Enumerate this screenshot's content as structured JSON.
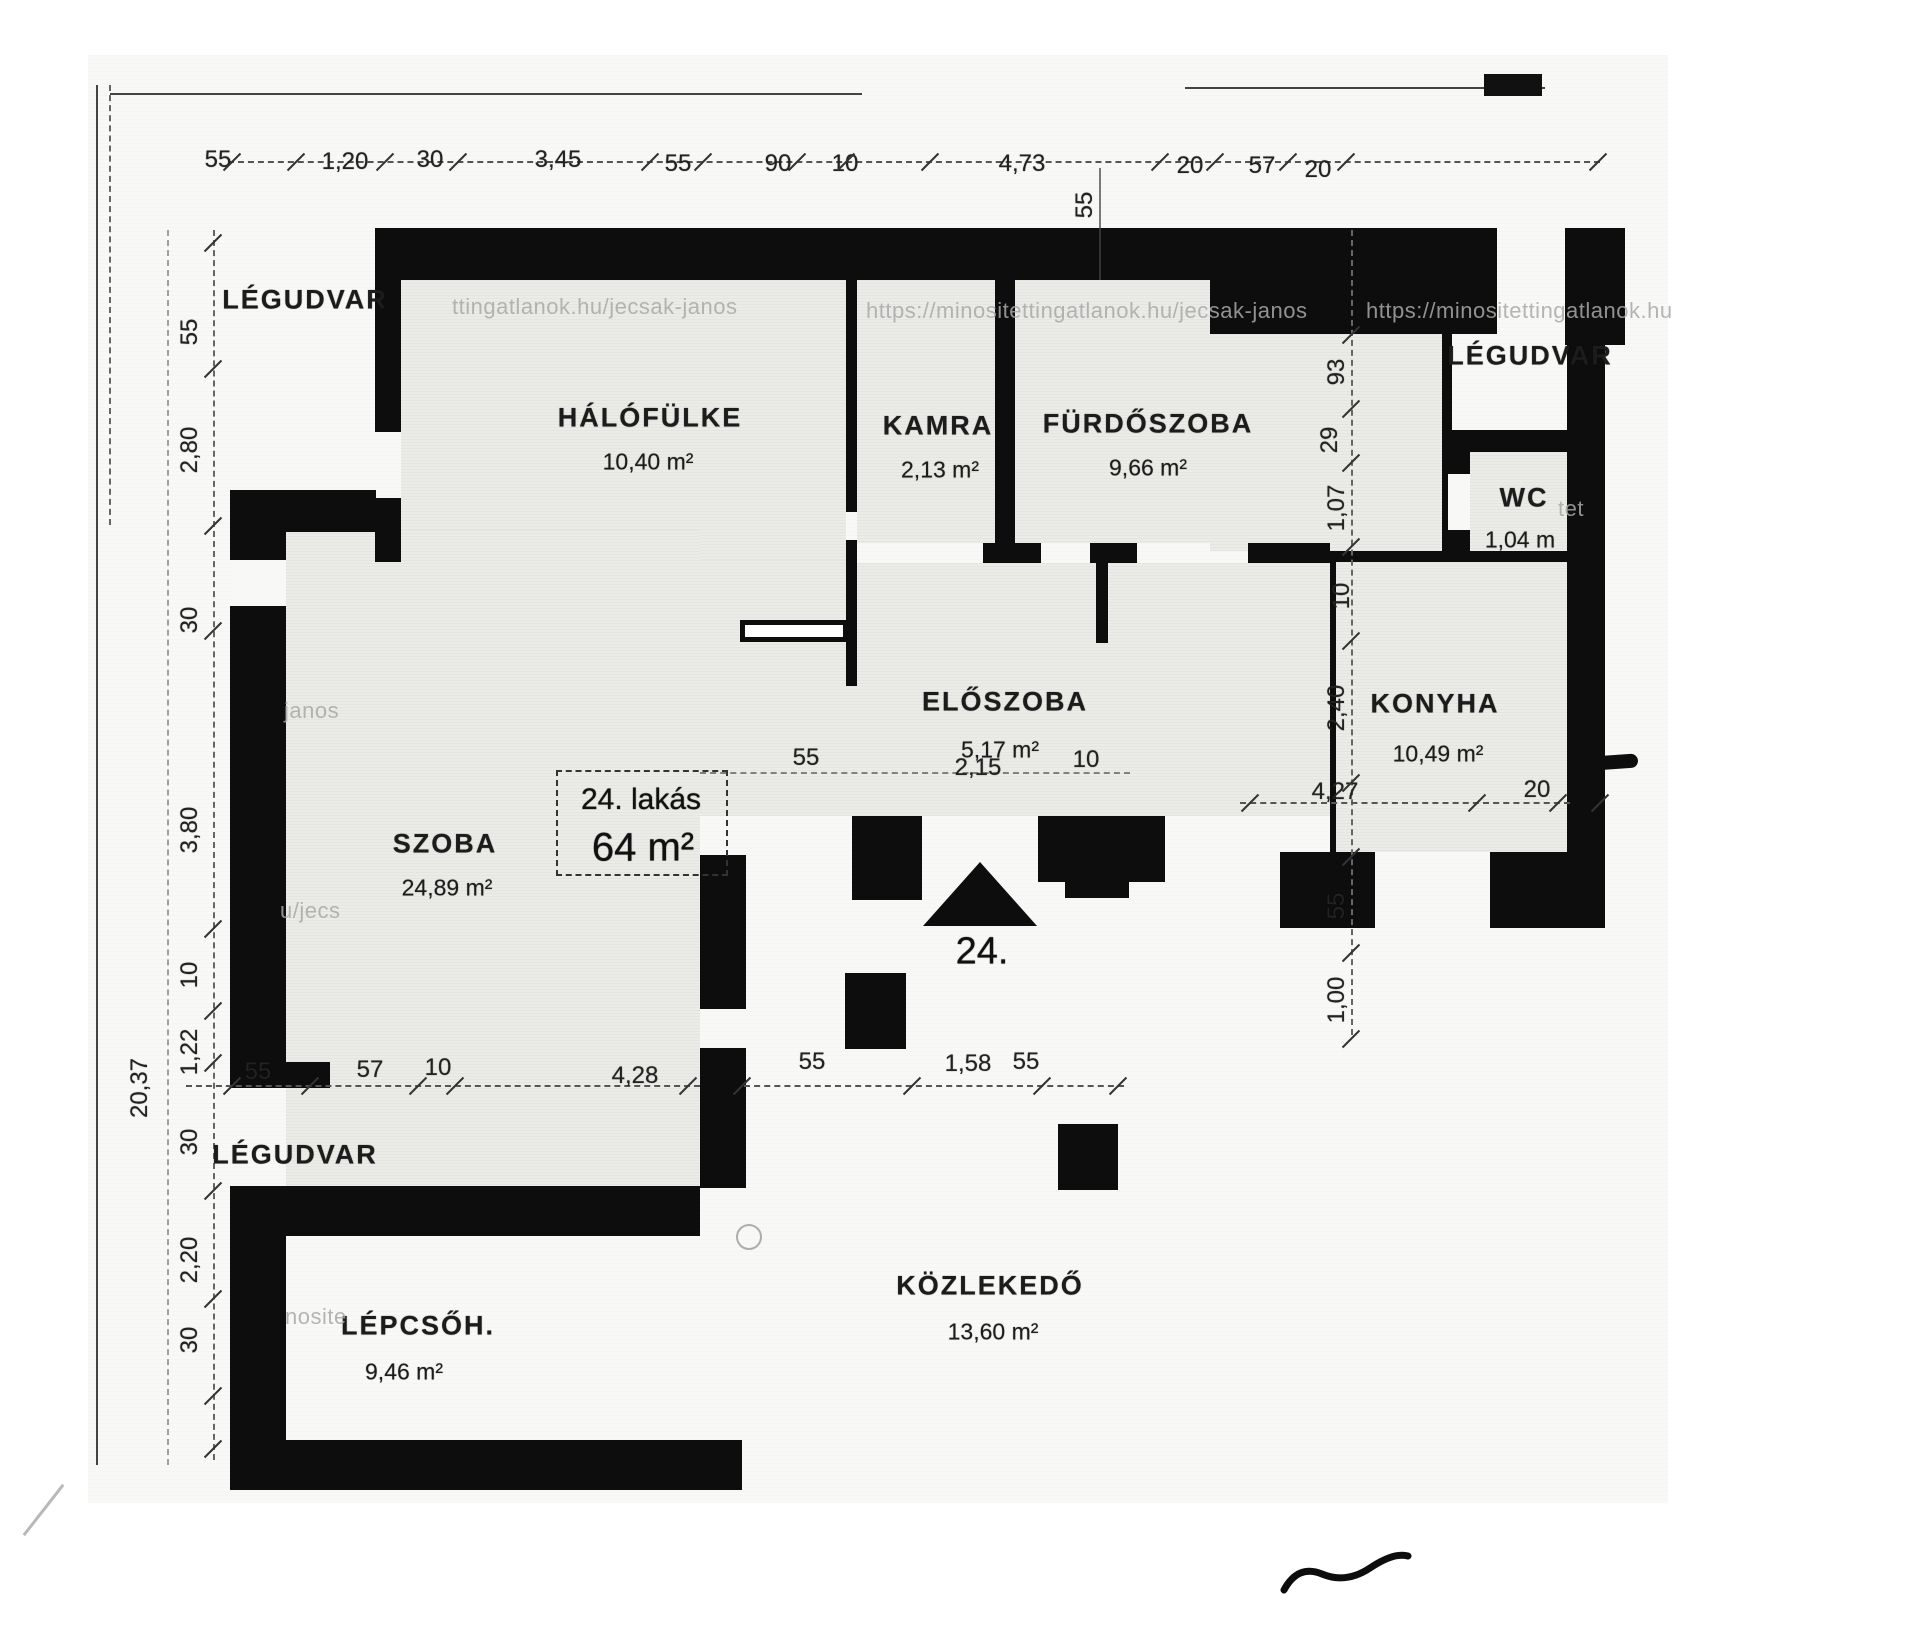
{
  "plan": {
    "unit_box": {
      "title": "24. lakás",
      "area": "64 m²"
    },
    "entrance": {
      "number": "24."
    },
    "rooms": [
      {
        "name": "LÉGUDVAR",
        "area": null,
        "nx": 305,
        "ny": 300,
        "ax": 0,
        "ay": 0
      },
      {
        "name": "HÁLÓFÜLKE",
        "area": "10,40 m²",
        "nx": 650,
        "ny": 418,
        "ax": 648,
        "ay": 462
      },
      {
        "name": "KAMRA",
        "area": "2,13 m²",
        "nx": 938,
        "ny": 426,
        "ax": 940,
        "ay": 470
      },
      {
        "name": "FÜRDŐSZOBA",
        "area": "9,66 m²",
        "nx": 1148,
        "ny": 424,
        "ax": 1148,
        "ay": 468
      },
      {
        "name": "LÉGUDVAR",
        "area": null,
        "nx": 1530,
        "ny": 356,
        "ax": 0,
        "ay": 0
      },
      {
        "name": "WC",
        "area": "1,04 m",
        "nx": 1524,
        "ny": 498,
        "ax": 1520,
        "ay": 540
      },
      {
        "name": "KONYHA",
        "area": "10,49 m²",
        "nx": 1435,
        "ny": 704,
        "ax": 1438,
        "ay": 754
      },
      {
        "name": "ELŐSZOBA",
        "area": "5,17 m²",
        "nx": 1005,
        "ny": 702,
        "ax": 1000,
        "ay": 750
      },
      {
        "name": "SZOBA",
        "area": "24,89 m²",
        "nx": 445,
        "ny": 844,
        "ax": 447,
        "ay": 888
      },
      {
        "name": "LÉGUDVAR",
        "area": null,
        "nx": 295,
        "ny": 1155,
        "ax": 0,
        "ay": 0
      },
      {
        "name": "LÉPCSŐH.",
        "area": "9,46 m²",
        "nx": 418,
        "ny": 1326,
        "ax": 404,
        "ay": 1372
      },
      {
        "name": "KÖZLEKEDŐ",
        "area": "13,60 m²",
        "nx": 990,
        "ny": 1286,
        "ax": 993,
        "ay": 1332
      }
    ],
    "dimensions": {
      "top_chain": [
        {
          "t": "55",
          "x": 218,
          "y": 160
        },
        {
          "t": "1,20",
          "x": 345,
          "y": 162
        },
        {
          "t": "30",
          "x": 430,
          "y": 160
        },
        {
          "t": "3,45",
          "x": 558,
          "y": 160
        },
        {
          "t": "55",
          "x": 678,
          "y": 164
        },
        {
          "t": "90",
          "x": 778,
          "y": 164
        },
        {
          "t": "10",
          "x": 845,
          "y": 164
        },
        {
          "t": "4,73",
          "x": 1022,
          "y": 164
        },
        {
          "t": "20",
          "x": 1190,
          "y": 166
        },
        {
          "t": "57",
          "x": 1262,
          "y": 166
        },
        {
          "t": "20",
          "x": 1318,
          "y": 170
        }
      ],
      "left_chain": [
        {
          "t": "55",
          "x": 190,
          "y": 332
        },
        {
          "t": "2,80",
          "x": 190,
          "y": 450
        },
        {
          "t": "30",
          "x": 190,
          "y": 620
        },
        {
          "t": "3,80",
          "x": 190,
          "y": 830
        },
        {
          "t": "10",
          "x": 190,
          "y": 975
        },
        {
          "t": "1,22",
          "x": 190,
          "y": 1052
        },
        {
          "t": "30",
          "x": 190,
          "y": 1142
        },
        {
          "t": "2,20",
          "x": 190,
          "y": 1260
        },
        {
          "t": "30",
          "x": 190,
          "y": 1340
        }
      ],
      "far_left": [
        {
          "t": "20,37",
          "x": 140,
          "y": 1088
        }
      ],
      "right_chain": [
        {
          "t": "55",
          "x": 1085,
          "y": 205
        },
        {
          "t": "93",
          "x": 1337,
          "y": 372
        },
        {
          "t": "29",
          "x": 1330,
          "y": 440
        },
        {
          "t": "1,07",
          "x": 1337,
          "y": 508
        },
        {
          "t": "10",
          "x": 1342,
          "y": 596
        },
        {
          "t": "2,40",
          "x": 1337,
          "y": 708
        },
        {
          "t": "55",
          "x": 1337,
          "y": 906
        },
        {
          "t": "1,00",
          "x": 1337,
          "y": 1000
        }
      ],
      "kitchen_chain": [
        {
          "t": "4,27",
          "x": 1335,
          "y": 792
        },
        {
          "t": "20",
          "x": 1537,
          "y": 790
        }
      ],
      "entry_chain": [
        {
          "t": "55",
          "x": 258,
          "y": 1072
        },
        {
          "t": "57",
          "x": 370,
          "y": 1070
        },
        {
          "t": "10",
          "x": 438,
          "y": 1068
        },
        {
          "t": "4,28",
          "x": 635,
          "y": 1076
        },
        {
          "t": "55",
          "x": 812,
          "y": 1062
        },
        {
          "t": "1,58",
          "x": 968,
          "y": 1064
        },
        {
          "t": "55",
          "x": 1026,
          "y": 1062
        }
      ],
      "hall_chain": [
        {
          "t": "55",
          "x": 806,
          "y": 758
        },
        {
          "t": "2,15",
          "x": 978,
          "y": 768
        },
        {
          "t": "10",
          "x": 1086,
          "y": 760
        }
      ]
    },
    "watermarks": [
      {
        "t": "ttingatlanok.hu/jecsak-janos",
        "x": 452,
        "y": 294
      },
      {
        "t": "https://minositettingatlanok.hu/jecsak-janos",
        "x": 866,
        "y": 298
      },
      {
        "t": "https://minositettingatlanok.hu",
        "x": 1366,
        "y": 298
      },
      {
        "t": "janos",
        "x": 284,
        "y": 698
      },
      {
        "t": "u/jecs",
        "x": 280,
        "y": 898
      },
      {
        "t": "nosite",
        "x": 285,
        "y": 1304
      },
      {
        "t": "tet",
        "x": 1558,
        "y": 496
      }
    ],
    "colors": {
      "wall": "#0d0d0d",
      "paper": "#f8f8f6",
      "room_fill": "#ebebe8",
      "dim_text": "#222222",
      "watermark": "#a9a9a9"
    }
  }
}
